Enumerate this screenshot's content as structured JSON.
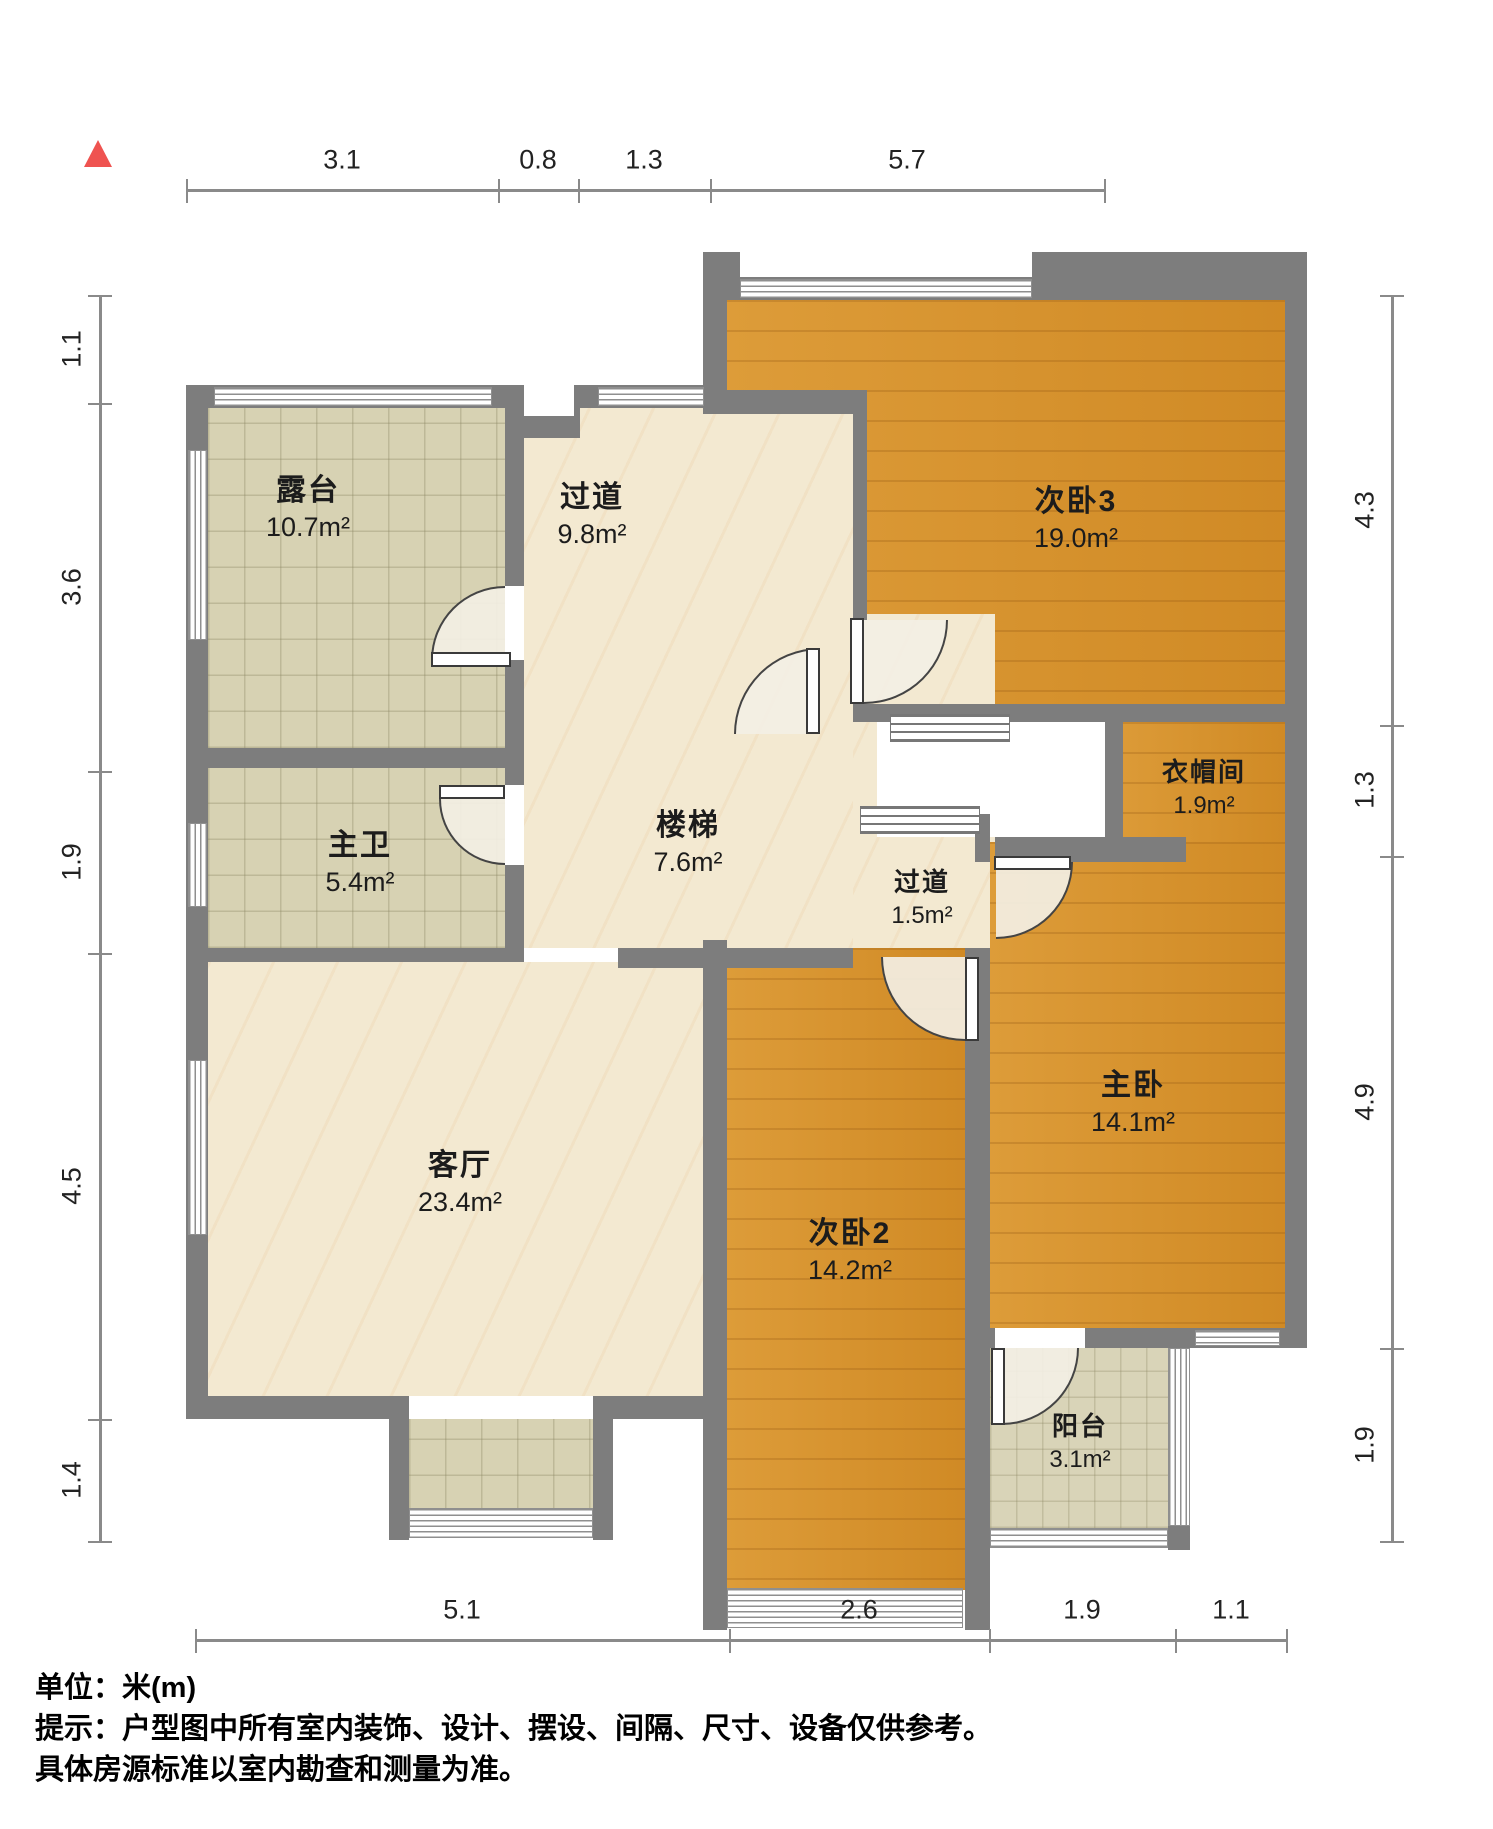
{
  "rooms": {
    "terrace": {
      "name": "露台",
      "area": "10.7m²"
    },
    "corridor": {
      "name": "过道",
      "area": "9.8m²"
    },
    "bedroom3": {
      "name": "次卧3",
      "area": "19.0m²"
    },
    "master_bath": {
      "name": "主卫",
      "area": "5.4m²"
    },
    "stairs": {
      "name": "楼梯",
      "area": "7.6m²"
    },
    "hallway": {
      "name": "过道",
      "area": "1.5m²"
    },
    "closet": {
      "name": "衣帽间",
      "area": "1.9m²"
    },
    "living": {
      "name": "客厅",
      "area": "23.4m²"
    },
    "bedroom2": {
      "name": "次卧2",
      "area": "14.2m²"
    },
    "master": {
      "name": "主卧",
      "area": "14.1m²"
    },
    "balcony": {
      "name": "阳台",
      "area": "3.1m²"
    }
  },
  "dimensions": {
    "top": [
      "3.1",
      "0.8",
      "1.3",
      "5.7"
    ],
    "left": [
      "1.1",
      "3.6",
      "1.9",
      "4.5",
      "1.4"
    ],
    "right": [
      "4.3",
      "1.3",
      "4.9",
      "1.9"
    ],
    "bottom": [
      "5.1",
      "2.6",
      "1.9",
      "1.1"
    ]
  },
  "footer": {
    "unit": "单位：米(m)",
    "tip1": "提示：户型图中所有室内装饰、设计、摆设、间隔、尺寸、设备仅供参考。",
    "tip2": "具体房源标准以室内勘查和测量为准。"
  },
  "colors": {
    "wall": "#7d7d7d",
    "wood_floor": "#d79330",
    "marble_floor": "#f3e9d1",
    "tile_floor": "#d7d2b3",
    "compass": "#ef5350",
    "dimension_line": "#8a8a8a"
  }
}
